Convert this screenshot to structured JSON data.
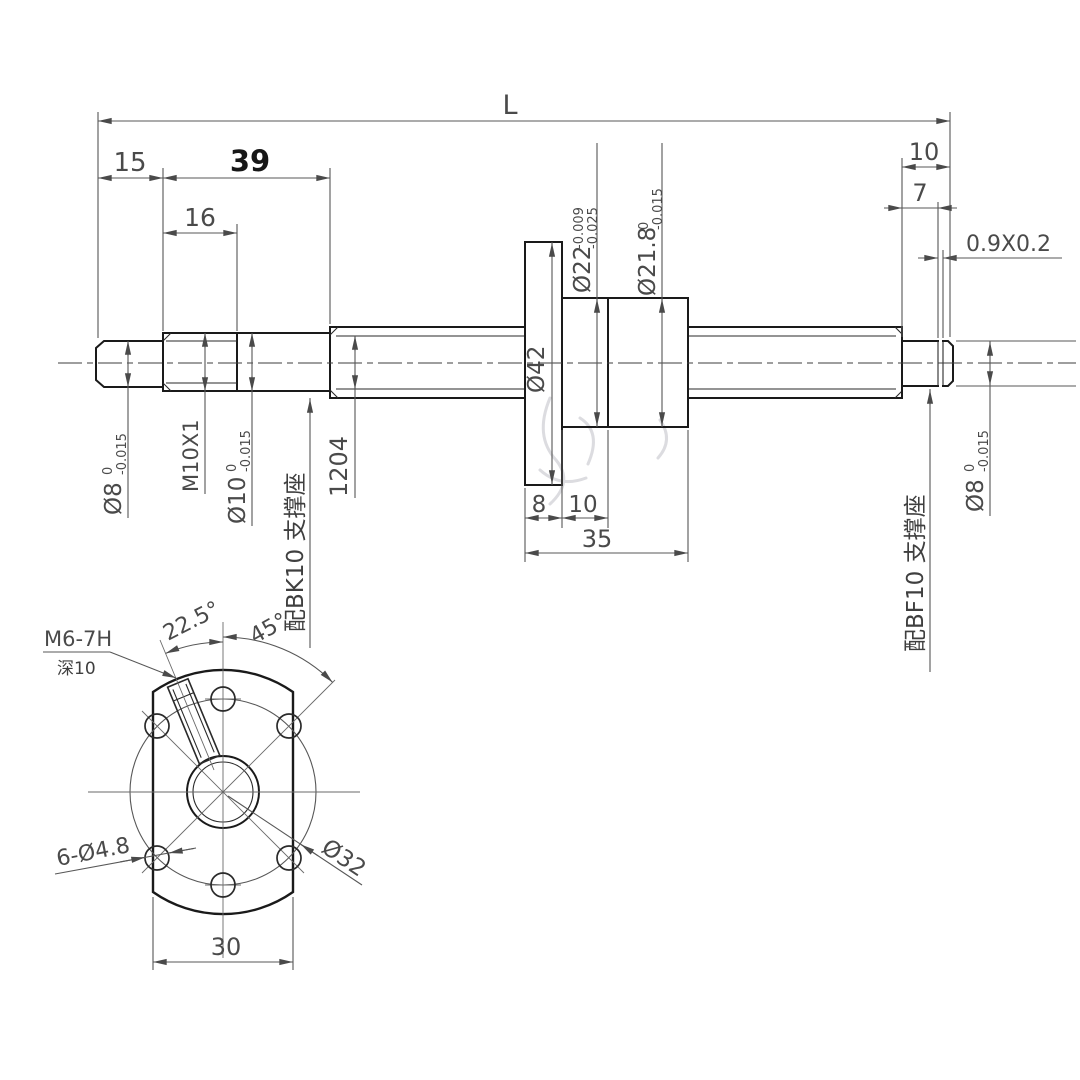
{
  "drawing": {
    "colors": {
      "part_line": "#1a1a1a",
      "dimension_line": "#575757",
      "text": "#4a4a4a",
      "background": "#ffffff"
    },
    "side_view": {
      "dim_overall_length": "L",
      "dim_left_end": "15",
      "dim_left_zone": "39",
      "dim_thread_length": "16",
      "dim_right_journal": "10",
      "dim_groove_position": "7",
      "dim_groove_size": "0.9X0.2",
      "dim_flange_thickness": "8",
      "dim_nut_front": "10",
      "dim_nut_length": "35",
      "label_d8_left": {
        "main": "Ø8",
        "tol_upper": "0",
        "tol_lower": "-0.015"
      },
      "label_thread": "M10X1",
      "label_d10": {
        "main": "Ø10",
        "tol_upper": "0",
        "tol_lower": "-0.015"
      },
      "label_bk10": "配BK10 支撑座",
      "label_screw_spec": "1204",
      "label_flange_diameter": "Ø42",
      "label_d22": {
        "main": "Ø22",
        "tol_upper": "-0.009",
        "tol_lower": "-0.025"
      },
      "label_d218": {
        "main": "Ø21.8",
        "tol_upper": "0",
        "tol_lower": "-0.015"
      },
      "label_bf10": "配BF10 支撑座",
      "label_d8_right": {
        "main": "Ø8",
        "tol_upper": "0",
        "tol_lower": "-0.015"
      }
    },
    "end_view": {
      "label_tap": "M6-7H",
      "label_tap_depth": "深10",
      "dim_angle_tap": "22.5°",
      "dim_angle_holes": "45°",
      "label_bolt_holes": "6-Ø4.8",
      "label_bolt_circle": "Ø32",
      "dim_width_across_flats": "30"
    }
  }
}
